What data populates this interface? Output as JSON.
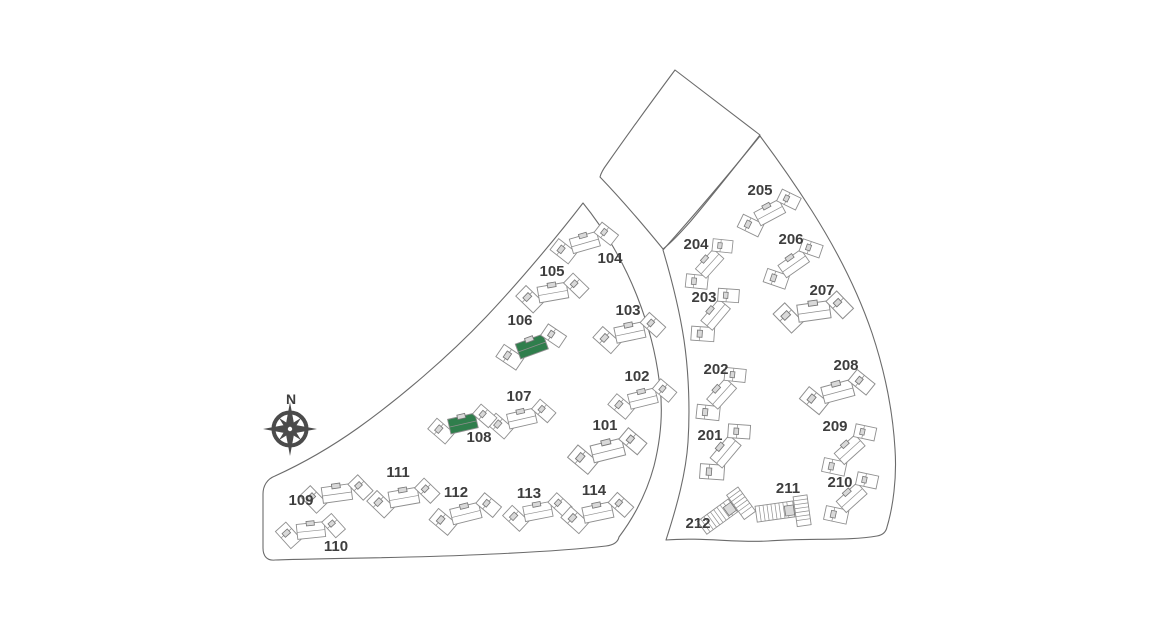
{
  "compass": {
    "label": "N"
  },
  "colors": {
    "highlight_green": "#2f7e4c",
    "building_stroke": "#8f8f8f",
    "building_core": "#d9d9d9",
    "boundary_gray": "#6b6b6b",
    "label_gray": "#3e3e3e",
    "compass_gray": "#4b4b4b",
    "background": "#ffffff"
  },
  "buildings": [
    {
      "id": "101",
      "label": "101",
      "type": "cluster",
      "highlight": false,
      "x": 608,
      "y": 451,
      "rot": -14,
      "scale": 1.15,
      "lx": 605,
      "ly": 430
    },
    {
      "id": "102",
      "label": "102",
      "type": "cluster",
      "highlight": false,
      "x": 643,
      "y": 399,
      "rot": -14,
      "scale": 1.0,
      "lx": 637,
      "ly": 381
    },
    {
      "id": "103",
      "label": "103",
      "type": "cluster",
      "highlight": false,
      "x": 630,
      "y": 333,
      "rot": -12,
      "scale": 1.05,
      "lx": 628,
      "ly": 315
    },
    {
      "id": "104",
      "label": "104",
      "type": "cluster",
      "highlight": false,
      "x": 585,
      "y": 243,
      "rot": -16,
      "scale": 1.0,
      "lx": 610,
      "ly": 263
    },
    {
      "id": "105",
      "label": "105",
      "type": "cluster",
      "highlight": false,
      "x": 553,
      "y": 293,
      "rot": -10,
      "scale": 1.05,
      "lx": 552,
      "ly": 276
    },
    {
      "id": "106",
      "label": "106",
      "type": "cluster",
      "highlight": true,
      "x": 532,
      "y": 347,
      "rot": -20,
      "scale": 1.05,
      "lx": 520,
      "ly": 325
    },
    {
      "id": "107",
      "label": "107",
      "type": "cluster",
      "highlight": false,
      "x": 522,
      "y": 419,
      "rot": -13,
      "scale": 1.0,
      "lx": 519,
      "ly": 401
    },
    {
      "id": "108",
      "label": "108",
      "type": "cluster",
      "highlight": true,
      "x": 463,
      "y": 424,
      "rot": -13,
      "scale": 1.0,
      "lx": 479,
      "ly": 442
    },
    {
      "id": "109",
      "label": "109",
      "type": "cluster",
      "highlight": false,
      "x": 337,
      "y": 494,
      "rot": -8,
      "scale": 1.05,
      "lx": 301,
      "ly": 505
    },
    {
      "id": "110",
      "label": "110",
      "type": "cluster",
      "highlight": false,
      "x": 311,
      "y": 531,
      "rot": -6,
      "scale": 1.0,
      "lx": 336,
      "ly": 551
    },
    {
      "id": "111",
      "label": "111",
      "type": "cluster",
      "highlight": false,
      "x": 404,
      "y": 498,
      "rot": -10,
      "scale": 1.05,
      "lx": 398,
      "ly": 477
    },
    {
      "id": "112",
      "label": "112",
      "type": "cluster",
      "highlight": false,
      "x": 466,
      "y": 514,
      "rot": -14,
      "scale": 1.05,
      "lx": 456,
      "ly": 497
    },
    {
      "id": "113",
      "label": "113",
      "type": "cluster",
      "highlight": false,
      "x": 538,
      "y": 512,
      "rot": -11,
      "scale": 1.0,
      "lx": 529,
      "ly": 498
    },
    {
      "id": "114",
      "label": "114",
      "type": "cluster",
      "highlight": false,
      "x": 598,
      "y": 513,
      "rot": -12,
      "scale": 1.05,
      "lx": 594,
      "ly": 495
    },
    {
      "id": "201",
      "label": "201",
      "type": "cluster",
      "highlight": false,
      "x": 726,
      "y": 452,
      "rot": -50,
      "scale": 1.05,
      "lx": 710,
      "ly": 440
    },
    {
      "id": "202",
      "label": "202",
      "type": "cluster",
      "highlight": false,
      "x": 722,
      "y": 394,
      "rot": -48,
      "scale": 1.0,
      "lx": 716,
      "ly": 374
    },
    {
      "id": "203",
      "label": "203",
      "type": "cluster",
      "highlight": false,
      "x": 716,
      "y": 315,
      "rot": -50,
      "scale": 1.0,
      "lx": 704,
      "ly": 302
    },
    {
      "id": "204",
      "label": "204",
      "type": "cluster",
      "highlight": false,
      "x": 710,
      "y": 264,
      "rot": -48,
      "scale": 0.95,
      "lx": 696,
      "ly": 249
    },
    {
      "id": "205",
      "label": "205",
      "type": "cluster",
      "highlight": false,
      "x": 770,
      "y": 213,
      "rot": -28,
      "scale": 1.0,
      "lx": 760,
      "ly": 195
    },
    {
      "id": "206",
      "label": "206",
      "type": "cluster",
      "highlight": false,
      "x": 794,
      "y": 264,
      "rot": -35,
      "scale": 1.0,
      "lx": 791,
      "ly": 244
    },
    {
      "id": "207",
      "label": "207",
      "type": "cluster",
      "highlight": false,
      "x": 814,
      "y": 312,
      "rot": -8,
      "scale": 1.15,
      "lx": 822,
      "ly": 295
    },
    {
      "id": "208",
      "label": "208",
      "type": "cluster",
      "highlight": false,
      "x": 838,
      "y": 392,
      "rot": -15,
      "scale": 1.1,
      "lx": 846,
      "ly": 370
    },
    {
      "id": "209",
      "label": "209",
      "type": "cluster",
      "highlight": false,
      "x": 850,
      "y": 450,
      "rot": -42,
      "scale": 1.0,
      "lx": 835,
      "ly": 431
    },
    {
      "id": "210",
      "label": "210",
      "type": "cluster",
      "highlight": false,
      "x": 852,
      "y": 498,
      "rot": -42,
      "scale": 1.0,
      "lx": 840,
      "ly": 487
    },
    {
      "id": "211",
      "label": "211",
      "type": "rows",
      "highlight": false,
      "x": 786,
      "y": 511,
      "rot": -8,
      "scale": 1.0,
      "lx": 788,
      "ly": 493
    },
    {
      "id": "212",
      "label": "212",
      "type": "rows",
      "highlight": false,
      "x": 727,
      "y": 511,
      "rot": -36,
      "scale": 1.0,
      "lx": 698,
      "ly": 528
    }
  ]
}
